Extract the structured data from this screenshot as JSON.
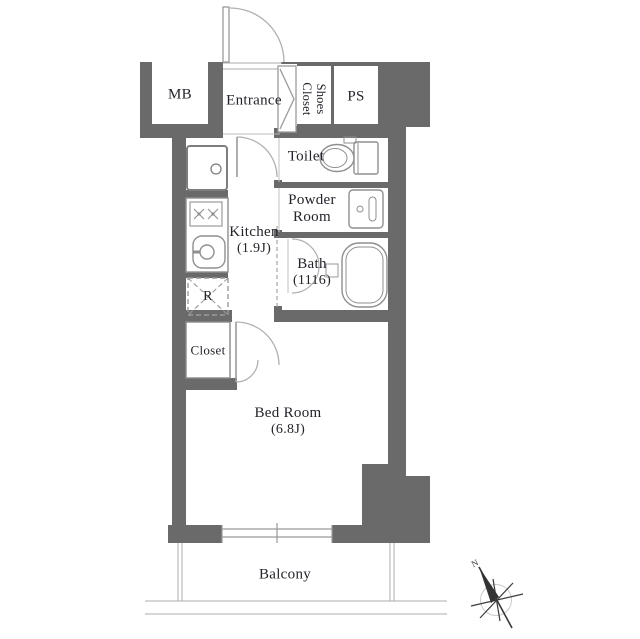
{
  "colors": {
    "wall": "#6a6a6a",
    "fixture_line": "#8f8f8f",
    "door_arc": "#b0b0b0",
    "text": "#23232b",
    "background": "#ffffff"
  },
  "rooms": {
    "mb": {
      "label": "MB"
    },
    "entrance": {
      "label": "Entrance"
    },
    "shoes_closet": {
      "label": "Shoes\nCloset"
    },
    "ps": {
      "label": "PS"
    },
    "toilet": {
      "label": "Toilet"
    },
    "powder_room": {
      "label": "Powder\nRoom"
    },
    "kitchen": {
      "label": "Kitchen",
      "size": "(1.9J)"
    },
    "bath": {
      "label": "Bath",
      "size": "(1116)"
    },
    "refrigerator_space": {
      "label": "R"
    },
    "closet": {
      "label": "Closet"
    },
    "bed_room": {
      "label": "Bed Room",
      "size": "(6.8J)"
    },
    "balcony": {
      "label": "Balcony"
    }
  },
  "compass": {
    "north_label": "N"
  }
}
